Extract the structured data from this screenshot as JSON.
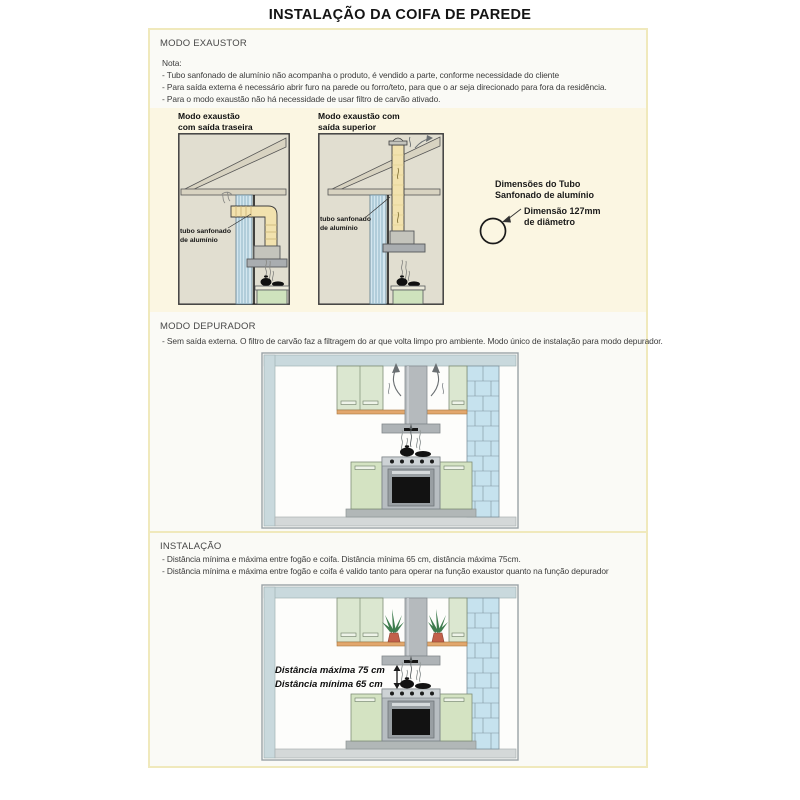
{
  "page": {
    "title": "INSTALAÇÃO DA COIFA DE PAREDE"
  },
  "sections": {
    "exaustor": {
      "heading": "MODO EXAUSTOR",
      "note_label": "Nota:",
      "notes": [
        "- Tubo sanfonado de alumínio não acompanha o produto, é vendido a parte, conforme necessidade do cliente",
        "- Para saída externa é necessário abrir furo na parede ou forro/teto, para que o ar seja direcionado para fora da residência.",
        "- Para o modo exaustão não há necessidade de usar filtro de carvão ativado."
      ]
    },
    "diagrams": {
      "rear_title": [
        "Modo exaustão",
        "com saída traseira"
      ],
      "top_title": [
        "Modo exaustão com",
        "saída superior"
      ],
      "pipe_label": [
        "tubo sanfonado",
        "de alumínio"
      ],
      "dims_title": [
        "Dimensões do Tubo",
        "Sanfonado de alumínio"
      ],
      "dims_value": [
        "Dimensão 127mm",
        "de diâmetro"
      ]
    },
    "depurador": {
      "heading": "MODO DEPURADOR",
      "notes": [
        "- Sem saída externa. O filtro de carvão faz a filtragem do ar que volta limpo pro ambiente. Modo único de instalação para modo depurador."
      ]
    },
    "instalacao": {
      "heading": "INSTALAÇÃO",
      "notes": [
        "- Distância mínima e máxima entre fogão e coifa. Distância mínima 65 cm, distância máxima 75cm.",
        "- Distância mínima e máxima entre fogão e coifa é valido tanto para operar na função exaustor quanto na função depurador"
      ],
      "distance_max": "Distância máxima 75 cm",
      "distance_min": "Distância mínima 65 cm"
    }
  },
  "colors": {
    "page_border_yellow": "#f0e9bc",
    "cream_panel": "#fbf6e2",
    "diagram_bg": "#e1ded0",
    "roof_beige": "#d8d3c1",
    "wall_stripe_blue": "#d3e6ef",
    "pipe_cream": "#f2e2ae",
    "hood_gray": "#b5babd",
    "cabinet_green": "#dbe7d0",
    "brick_blue": "#c6e2ee",
    "shelf_orange": "#e2a76d",
    "ceiling_band": "#c9d9dd"
  }
}
